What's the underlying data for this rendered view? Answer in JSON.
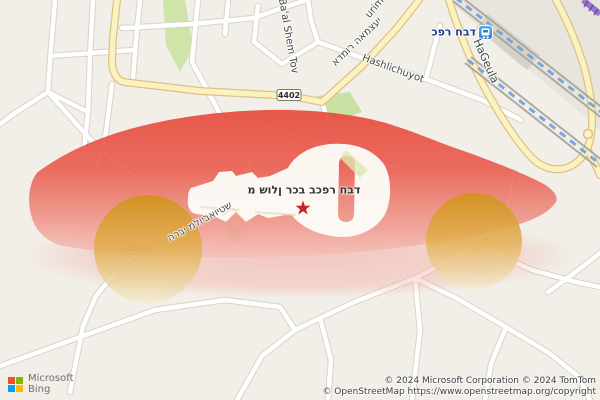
{
  "map": {
    "poi": {
      "label": "מ שולן רכב בכפר חבד"
    },
    "station": {
      "label": "כפר חבד"
    },
    "streets": {
      "baal_shem_tov": "Ba'al Shem Tov",
      "admor": "אדמור האמצעי",
      "urim": "urim",
      "hashlichuyot": "Hashlichuyot",
      "hageula": "HaGeula",
      "harabbi": "הרבי מלויבאויטש"
    },
    "route_shield": "4402",
    "colors": {
      "background": "#F1EFE8",
      "road": "#FFFFFF",
      "road_casing": "#D8D4C9",
      "main_road": "#FBF2BF",
      "main_road_casing": "#D9C388",
      "green_area": "#CFE4A8",
      "railway_dash": "#7AA6DB",
      "railway_rail": "#ADAAA1",
      "purple_road": "#9678C6",
      "overlay_red": "#E8493B",
      "wheel_orange": "#D79A2B",
      "star": "#C1292B",
      "station_icon_blue": "#3E8EDB"
    }
  },
  "branding": {
    "line1": "Microsoft",
    "line2": "Bing"
  },
  "attribution": {
    "line1": "© 2024 Microsoft Corporation © 2024 TomTom",
    "line2": "© OpenStreetMap https://www.openstreetmap.org/copyright"
  }
}
